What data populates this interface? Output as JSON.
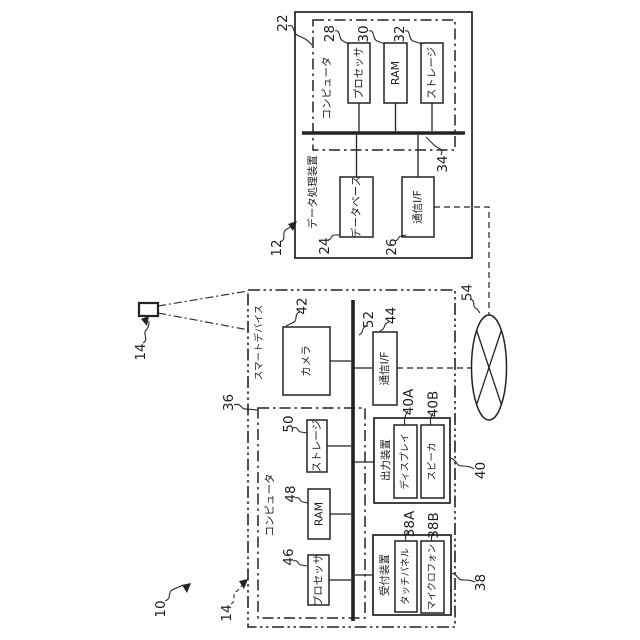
{
  "figure": {
    "background": "#ffffff",
    "line_color": "#222222",
    "description_tags": {
      "orientation": "rotated-90-ccw"
    }
  },
  "system": {
    "ref": "10"
  },
  "device_icon": {
    "ref": "14"
  },
  "network": {
    "ref": "54"
  },
  "data_processing_device": {
    "name": "データ処理装置",
    "ref": "12",
    "computer": {
      "name": "コンピュータ",
      "ref": "22"
    },
    "processor": {
      "name": "プロセッサ",
      "ref": "28"
    },
    "ram": {
      "name": "RAM",
      "ref": "30"
    },
    "storage": {
      "name": "ストレージ",
      "ref": "32"
    },
    "bus": {
      "ref": "34"
    },
    "database": {
      "name": "データベース",
      "ref": "24"
    },
    "comm_if": {
      "name": "通信I/F",
      "ref": "26"
    }
  },
  "smart_device": {
    "name": "スマートデバイス",
    "ref": "14",
    "camera": {
      "name": "カメラ",
      "ref": "42"
    },
    "bus": {
      "ref": "52"
    },
    "comm_if": {
      "name": "通信I/F",
      "ref": "44"
    },
    "computer": {
      "name": "コンピュータ",
      "ref": "36"
    },
    "processor": {
      "name": "プロセッサ",
      "ref": "46"
    },
    "ram": {
      "name": "RAM",
      "ref": "48"
    },
    "storage": {
      "name": "ストレージ",
      "ref": "50"
    },
    "output_device": {
      "name": "出力装置",
      "ref": "40",
      "display": {
        "name": "ディスプレイ",
        "ref": "40A"
      },
      "speaker": {
        "name": "スピーカ",
        "ref": "40B"
      }
    },
    "reception_device": {
      "name": "受付装置",
      "ref": "38",
      "touch_panel": {
        "name": "タッチパネル",
        "ref": "38A"
      },
      "microphone": {
        "name": "マイクロフォン",
        "ref": "38B"
      }
    }
  }
}
